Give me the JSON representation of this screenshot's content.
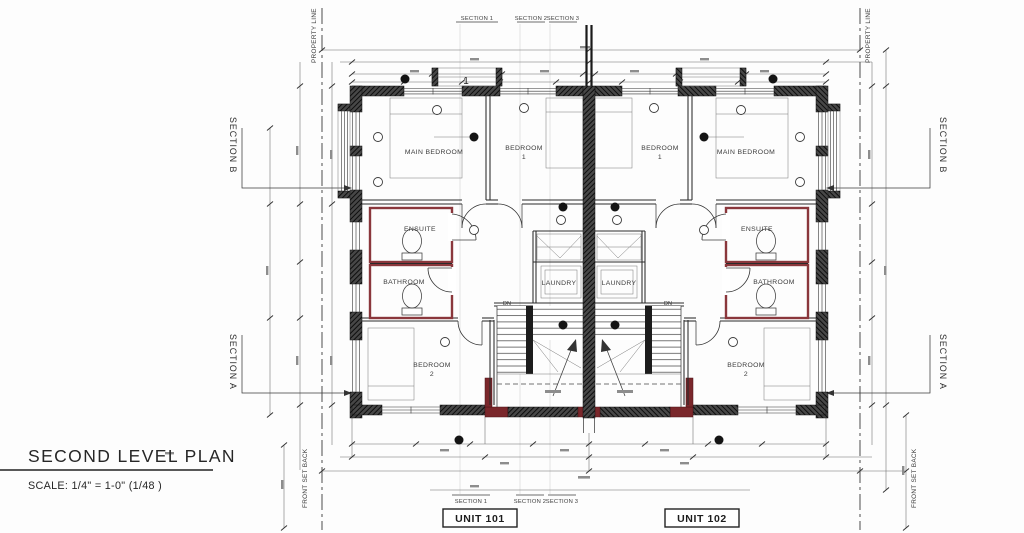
{
  "drawing": {
    "title": "SECOND LEVEL PLAN",
    "scale_note": "SCALE: 1/4\" = 1-0\"   (1/48 )"
  },
  "site": {
    "property_line": "PROPERTY LINE",
    "front_set_back": "FRONT SET BACK",
    "section_a": "SECTION A",
    "section_b": "SECTION B"
  },
  "section_cuts": {
    "section_1": "SECTION 1",
    "section_2": "SECTION 2",
    "section_3": "SECTION 3"
  },
  "units": {
    "unit_101": "UNIT 101",
    "unit_102": "UNIT 102"
  },
  "rooms": {
    "main_bedroom": "MAIN BEDROOM",
    "bedroom": "BEDROOM",
    "bedroom_1_num": "1",
    "bedroom_2_num": "2",
    "ensuite": "ENSUITE",
    "bathroom": "BATHROOM",
    "laundry": "LAUNDRY"
  },
  "stairs": {
    "down_label": "DN"
  },
  "tags": {
    "window_tag": "1"
  },
  "colors": {
    "wall_dark": "#1f1f1f",
    "wet_wall_red": "#8a373c",
    "entry_wall_red": "#7a272b",
    "dim_line": "#6a6a6a",
    "ink": "#2e2e2e"
  }
}
